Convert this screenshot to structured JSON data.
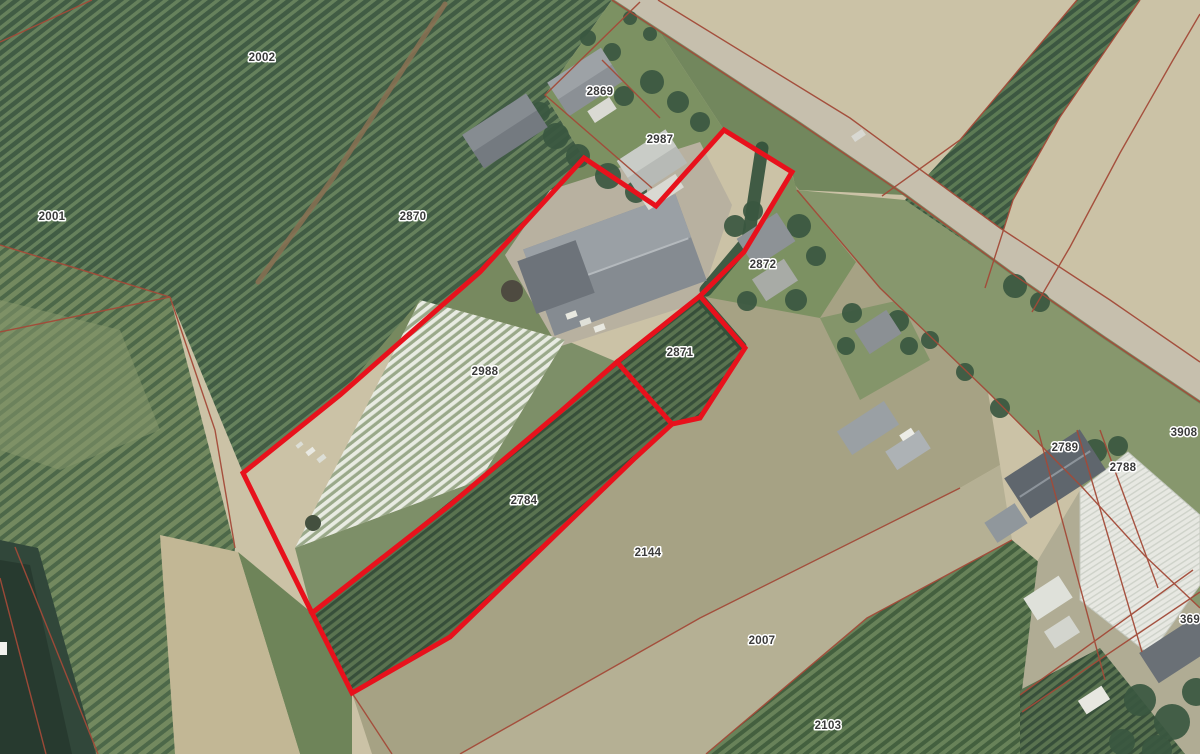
{
  "app": {
    "description": "Aerial cadastral parcel map with highlighted selection"
  },
  "canvas": {
    "width": 1200,
    "height": 754
  },
  "colors": {
    "selection_red": "#e8111c",
    "cadastral_red": "#a34a38",
    "label_text": "#3a3a3a",
    "label_halo": "#ffffff",
    "base_field": "#cbc2a6",
    "road": "#c6bfad",
    "water": "#31473a"
  },
  "parcel_labels": [
    {
      "text": "2002",
      "x": 262,
      "y": 58
    },
    {
      "text": "2869",
      "x": 600,
      "y": 92
    },
    {
      "text": "2987",
      "x": 660,
      "y": 140
    },
    {
      "text": "2870",
      "x": 413,
      "y": 217
    },
    {
      "text": "2001",
      "x": 52,
      "y": 217
    },
    {
      "text": "2872",
      "x": 763,
      "y": 265
    },
    {
      "text": "2871",
      "x": 680,
      "y": 353
    },
    {
      "text": "2988",
      "x": 485,
      "y": 372
    },
    {
      "text": "2784",
      "x": 524,
      "y": 501
    },
    {
      "text": "2144",
      "x": 648,
      "y": 553
    },
    {
      "text": "2007",
      "x": 762,
      "y": 641
    },
    {
      "text": "2103",
      "x": 828,
      "y": 726
    },
    {
      "text": "2789",
      "x": 1065,
      "y": 448
    },
    {
      "text": "2788",
      "x": 1123,
      "y": 468
    },
    {
      "text": "3908",
      "x": 1184,
      "y": 433
    },
    {
      "text": "369",
      "x": 1190,
      "y": 620
    }
  ],
  "selection_overlay": {
    "stroke_width": 5,
    "outer": "584,158 656,206 724,130 792,172 744,252 700,296 745,348 700,418 672,424 635,458 450,637 352,693 312,613 243,473 340,395 480,272",
    "dividers": [
      "312,613 450,505 560,412 617,362 700,296",
      "617,362 672,424"
    ]
  },
  "cadastral_lines": [
    "0,42 92,0",
    "612,0 795,120 905,195 1010,272 1105,338 1200,402",
    "658,0 850,118 1000,228 1110,300 1200,362",
    "640,2 545,95 652,188",
    "602,60 660,118",
    "0,245 170,297",
    "0,332 170,297",
    "170,297 215,430 235,548",
    "15,547 98,754",
    "0,578 46,754",
    "1077,0 960,140 882,196",
    "1140,0 1060,117 1013,200 985,288",
    "1200,14 1173,60 1120,153 1070,247 1032,312",
    "797,190 880,288 988,392 1082,487 1145,556 1200,608",
    "460,754 700,618 960,488",
    "706,754 867,618 1012,540",
    "1038,430 1105,680",
    "1077,430 1142,652",
    "1100,430 1158,588",
    "1020,695 1193,570",
    "1022,712 1200,592",
    "352,693 392,754"
  ],
  "scene": {
    "patterns": [
      {
        "id": "orchA",
        "bg": "#66815c",
        "fg": "#415c44",
        "gap": 8,
        "sw": 4.5,
        "angle": -38
      },
      {
        "id": "orchB",
        "bg": "#73895f",
        "fg": "#4d6849",
        "gap": 9,
        "sw": 4,
        "angle": -38
      },
      {
        "id": "rows",
        "bg": "#5a7350",
        "fg": "#374f3a",
        "gap": 7,
        "sw": 3.2,
        "angle": -38
      },
      {
        "id": "tunnel",
        "bg": "#9aa98a",
        "fg": "#e8ebe2",
        "gap": 7,
        "sw": 3.8,
        "angle": -38
      },
      {
        "id": "o2103",
        "bg": "#688259",
        "fg": "#44603f",
        "gap": 8,
        "sw": 4,
        "angle": -38
      },
      {
        "id": "orchTR",
        "bg": "#5c7a54",
        "fg": "#3c5741",
        "gap": 7.5,
        "sw": 4,
        "angle": -38
      },
      {
        "id": "gh",
        "bg": "#e7e8e2",
        "fg": "#ced2c9",
        "gap": 5,
        "sw": 1.4,
        "angle": -33
      }
    ],
    "fields": [
      {
        "name": "orchard-northwest",
        "pattern": "orchA",
        "pts": "0,0 612,0 545,95 584,158 480,272 340,395 243,473 170,297 0,245"
      },
      {
        "name": "gardens-2869-2987",
        "fill": "#7c9162",
        "pts": "545,95 612,0 640,2 724,130 656,206 584,158"
      },
      {
        "name": "hedgerow-strip",
        "fill": "#72875d",
        "pts": "640,2 658,0 850,118 905,195 797,190 744,252 792,172 724,130"
      },
      {
        "name": "field-left",
        "pattern": "orchB",
        "pts": "0,245 170,297 235,548 212,754 0,754"
      },
      {
        "name": "meadow-left-patch",
        "fill": "#87986b",
        "op": 0.55,
        "pts": "0,300 120,330 160,430 60,470 0,450"
      },
      {
        "name": "orchard-topright",
        "pattern": "orchTR",
        "pts": "1077,0 1140,0 1060,117 1013,200 985,288 905,200 960,140"
      },
      {
        "name": "field-2144",
        "fill": "#a6a284",
        "pts": "792,172 795,185 880,288 988,392 1000,465 960,488 700,618 460,754 372,754 352,693 450,637 635,458 672,424 700,418 745,348 700,296 744,252"
      },
      {
        "name": "garden-2872",
        "fill": "#7c9162",
        "pts": "744,252 792,175 797,190 856,262 820,318 700,296"
      },
      {
        "name": "garden-farm2",
        "fill": "#84956a",
        "pts": "820,318 900,300 930,360 860,400"
      },
      {
        "name": "field-2007",
        "fill": "#b5b094",
        "pts": "460,754 700,618 960,488 1000,465 1012,540 867,618 706,754"
      },
      {
        "name": "orchard-2103",
        "pattern": "o2103",
        "pts": "706,754 867,618 1012,540 1085,600 1100,754"
      },
      {
        "name": "roadside-gardens",
        "fill": "#87976d",
        "pts": "797,190 905,200 1010,272 1105,338 1200,402 1200,608 1145,556 1082,487 988,392 880,288"
      },
      {
        "name": "yard-southeast",
        "fill": "#b0ac94",
        "pts": "1082,487 1145,556 1200,608 1200,754 1020,754 1022,690 1038,560"
      },
      {
        "name": "orchard-bottomright",
        "pattern": "rows",
        "pts": "1020,690 1100,648 1185,754 1020,754"
      },
      {
        "name": "parcel-2988-green",
        "fill": "#7d8f68",
        "pts": "295,548 480,480 565,340 617,362 560,412 312,613"
      },
      {
        "name": "parcel-2988-north",
        "fill": "#77895f",
        "pts": "480,272 584,158 656,206 565,340 420,300 340,395"
      },
      {
        "name": "farmyard",
        "fill": "#b8b1a0",
        "pts": "505,255 550,190 700,142 732,205 700,302 558,347"
      },
      {
        "name": "tunnel-field-2988",
        "pattern": "tunnel",
        "pts": "420,300 565,340 480,480 295,548"
      },
      {
        "name": "rows-2784",
        "pattern": "rows",
        "pts": "312,613 560,412 617,362 672,424 635,458 450,637 352,693"
      },
      {
        "name": "rows-2871",
        "pattern": "rows",
        "pts": "617,362 700,296 745,348 700,418 672,424"
      },
      {
        "name": "grass-strip-dirtroad",
        "fill": "#6e8459",
        "pts": "238,552 312,613 352,693 352,754 300,754"
      }
    ],
    "surfaces": [
      {
        "name": "main-road",
        "fill": "#c6bfad",
        "pts": "612,0 658,0 850,118 1000,228 1110,300 1200,362 1200,402 1105,338 1010,272 905,195 795,120"
      },
      {
        "name": "dirt-road",
        "fill": "#c2b795",
        "pts": "160,535 238,552 300,754 175,754"
      },
      {
        "name": "waterway",
        "fill": "#31473a",
        "pts": "0,540 38,548 96,754 0,754"
      },
      {
        "name": "waterway-dark",
        "fill": "#273a2f",
        "pts": "0,560 30,565 72,754 0,754"
      }
    ],
    "strokes": [
      {
        "name": "road-verge",
        "pts": "612,0 795,120 905,195 1010,272 1105,338 1200,402",
        "color": "#6d7f56",
        "w": 3,
        "op": 0.8
      },
      {
        "name": "orchard-track",
        "pts": "445,4 333,178 258,282",
        "color": "#8a7052",
        "w": 5,
        "op": 0.85
      }
    ],
    "hedges": [
      {
        "pts": "762,148 748,240 706,290",
        "w": 13
      },
      {
        "pts": "702,300 742,346",
        "w": 9
      }
    ],
    "buildings": [
      {
        "name": "barn-main",
        "cx": 615,
        "cy": 265,
        "w": 162,
        "h": 92,
        "rot": -20,
        "fill": "#858b91",
        "top": "#9aa0a5",
        "ridge": "#b4b9bd"
      },
      {
        "name": "barn-wing",
        "cx": 556,
        "cy": 277,
        "w": 62,
        "h": 56,
        "rot": -20,
        "fill": "#6d737a"
      },
      {
        "name": "house-2987",
        "cx": 652,
        "cy": 162,
        "w": 58,
        "h": 40,
        "rot": -33,
        "fill": "#b7bab6",
        "top": "#c9ccc7"
      },
      {
        "name": "patio-2987",
        "cx": 662,
        "cy": 192,
        "w": 42,
        "h": 16,
        "rot": -33,
        "fill": "#d9d9d2"
      },
      {
        "name": "house-2869",
        "cx": 585,
        "cy": 82,
        "w": 64,
        "h": 40,
        "rot": -33,
        "fill": "#8b9095",
        "top": "#9da2a6"
      },
      {
        "name": "annex-2869",
        "cx": 602,
        "cy": 110,
        "w": 26,
        "h": 14,
        "rot": -33,
        "fill": "#dadad3"
      },
      {
        "name": "shed-west",
        "cx": 505,
        "cy": 131,
        "w": 76,
        "h": 40,
        "rot": -33,
        "fill": "#747a80",
        "top": "#868c91"
      },
      {
        "name": "house-2872",
        "cx": 766,
        "cy": 240,
        "w": 48,
        "h": 34,
        "rot": -33,
        "fill": "#8d9296"
      },
      {
        "name": "annex-2872",
        "cx": 775,
        "cy": 280,
        "w": 38,
        "h": 26,
        "rot": -33,
        "fill": "#a8aba6"
      },
      {
        "name": "small-house",
        "cx": 878,
        "cy": 332,
        "w": 38,
        "h": 28,
        "rot": -33,
        "fill": "#8b9094"
      },
      {
        "name": "shed-a",
        "cx": 868,
        "cy": 428,
        "w": 56,
        "h": 28,
        "rot": -33,
        "fill": "#9aa0a4"
      },
      {
        "name": "shed-b",
        "cx": 908,
        "cy": 450,
        "w": 40,
        "h": 22,
        "rot": -33,
        "fill": "#adb2b5"
      },
      {
        "name": "barn-2789",
        "cx": 1055,
        "cy": 474,
        "w": 90,
        "h": 48,
        "rot": -33,
        "fill": "#5f666d",
        "ridge": "#8d949b"
      },
      {
        "name": "shed-2789",
        "cx": 1006,
        "cy": 523,
        "w": 36,
        "h": 24,
        "rot": -33,
        "fill": "#90979c"
      },
      {
        "name": "building-369",
        "cx": 1180,
        "cy": 648,
        "w": 74,
        "h": 36,
        "rot": -33,
        "fill": "#6a7076"
      },
      {
        "name": "gh-shed-1",
        "cx": 1048,
        "cy": 598,
        "w": 42,
        "h": 26,
        "rot": -33,
        "fill": "#dfe1da"
      },
      {
        "name": "gh-shed-2",
        "cx": 1062,
        "cy": 632,
        "w": 30,
        "h": 20,
        "rot": -33,
        "fill": "#d3d5ce"
      },
      {
        "name": "gh-shed-3",
        "cx": 1094,
        "cy": 700,
        "w": 28,
        "h": 16,
        "rot": -33,
        "fill": "#e7e7e0"
      }
    ],
    "greenhouse": {
      "pts": "1080,490 1128,452 1200,515 1200,585 1150,655 1080,600",
      "stroke": "#c4c8bf"
    },
    "trees": [
      [
        540,
        112,
        10
      ],
      [
        556,
        136,
        13
      ],
      [
        578,
        156,
        12
      ],
      [
        608,
        176,
        13
      ],
      [
        636,
        192,
        11
      ],
      [
        660,
        206,
        9
      ],
      [
        624,
        96,
        10
      ],
      [
        652,
        82,
        12
      ],
      [
        678,
        102,
        11
      ],
      [
        700,
        122,
        10
      ],
      [
        588,
        38,
        8
      ],
      [
        612,
        52,
        9
      ],
      [
        630,
        18,
        7
      ],
      [
        650,
        34,
        7
      ],
      [
        735,
        226,
        11
      ],
      [
        753,
        211,
        10
      ],
      [
        799,
        226,
        12
      ],
      [
        816,
        256,
        10
      ],
      [
        796,
        300,
        11
      ],
      [
        747,
        301,
        10
      ],
      [
        852,
        313,
        10
      ],
      [
        898,
        321,
        11
      ],
      [
        909,
        346,
        9
      ],
      [
        846,
        346,
        9
      ],
      [
        1015,
        286,
        12
      ],
      [
        1040,
        302,
        10
      ],
      [
        930,
        340,
        9
      ],
      [
        965,
        372,
        9
      ],
      [
        1000,
        408,
        10
      ],
      [
        1095,
        451,
        12
      ],
      [
        1118,
        446,
        10
      ],
      [
        1141,
        481,
        11
      ],
      [
        1108,
        501,
        10
      ],
      [
        1140,
        700,
        16
      ],
      [
        1172,
        722,
        18
      ],
      [
        1196,
        692,
        14
      ],
      [
        1122,
        742,
        13
      ],
      [
        1157,
        750,
        15
      ]
    ],
    "misc_rects": [
      {
        "name": "crate",
        "x": 566,
        "y": 312,
        "w": 11,
        "h": 6,
        "rot": -20,
        "fill": "#e8e8e0"
      },
      {
        "name": "crate",
        "x": 580,
        "y": 319,
        "w": 11,
        "h": 6,
        "rot": -20,
        "fill": "#dfe0d8"
      },
      {
        "name": "crate",
        "x": 594,
        "y": 325,
        "w": 11,
        "h": 6,
        "rot": -20,
        "fill": "#e8e8e0"
      },
      {
        "name": "van",
        "x": 900,
        "y": 431,
        "w": 14,
        "h": 7,
        "rot": -33,
        "fill": "#ecece6"
      },
      {
        "name": "car",
        "x": 852,
        "y": 132,
        "w": 13,
        "h": 7,
        "rot": -34,
        "fill": "#d8d8d2"
      },
      {
        "name": "equipment",
        "x": 306,
        "y": 449,
        "w": 9,
        "h": 5,
        "rot": -38,
        "fill": "#e9e9e2"
      },
      {
        "name": "equipment",
        "x": 317,
        "y": 456,
        "w": 9,
        "h": 5,
        "rot": -38,
        "fill": "#dcded6"
      },
      {
        "name": "equipment",
        "x": 296,
        "y": 443,
        "w": 7,
        "h": 4,
        "rot": -38,
        "fill": "#dcded6"
      },
      {
        "name": "partial-label",
        "x": 0,
        "y": 642,
        "w": 7,
        "h": 13,
        "rot": 0,
        "fill": "#f2f2ee"
      }
    ],
    "misc_circles": [
      {
        "name": "silo-pit",
        "cx": 512,
        "cy": 291,
        "r": 11,
        "fill": "#4e4a40"
      },
      {
        "name": "dark-spot",
        "cx": 313,
        "cy": 523,
        "r": 8,
        "fill": "#44503f"
      }
    ]
  }
}
